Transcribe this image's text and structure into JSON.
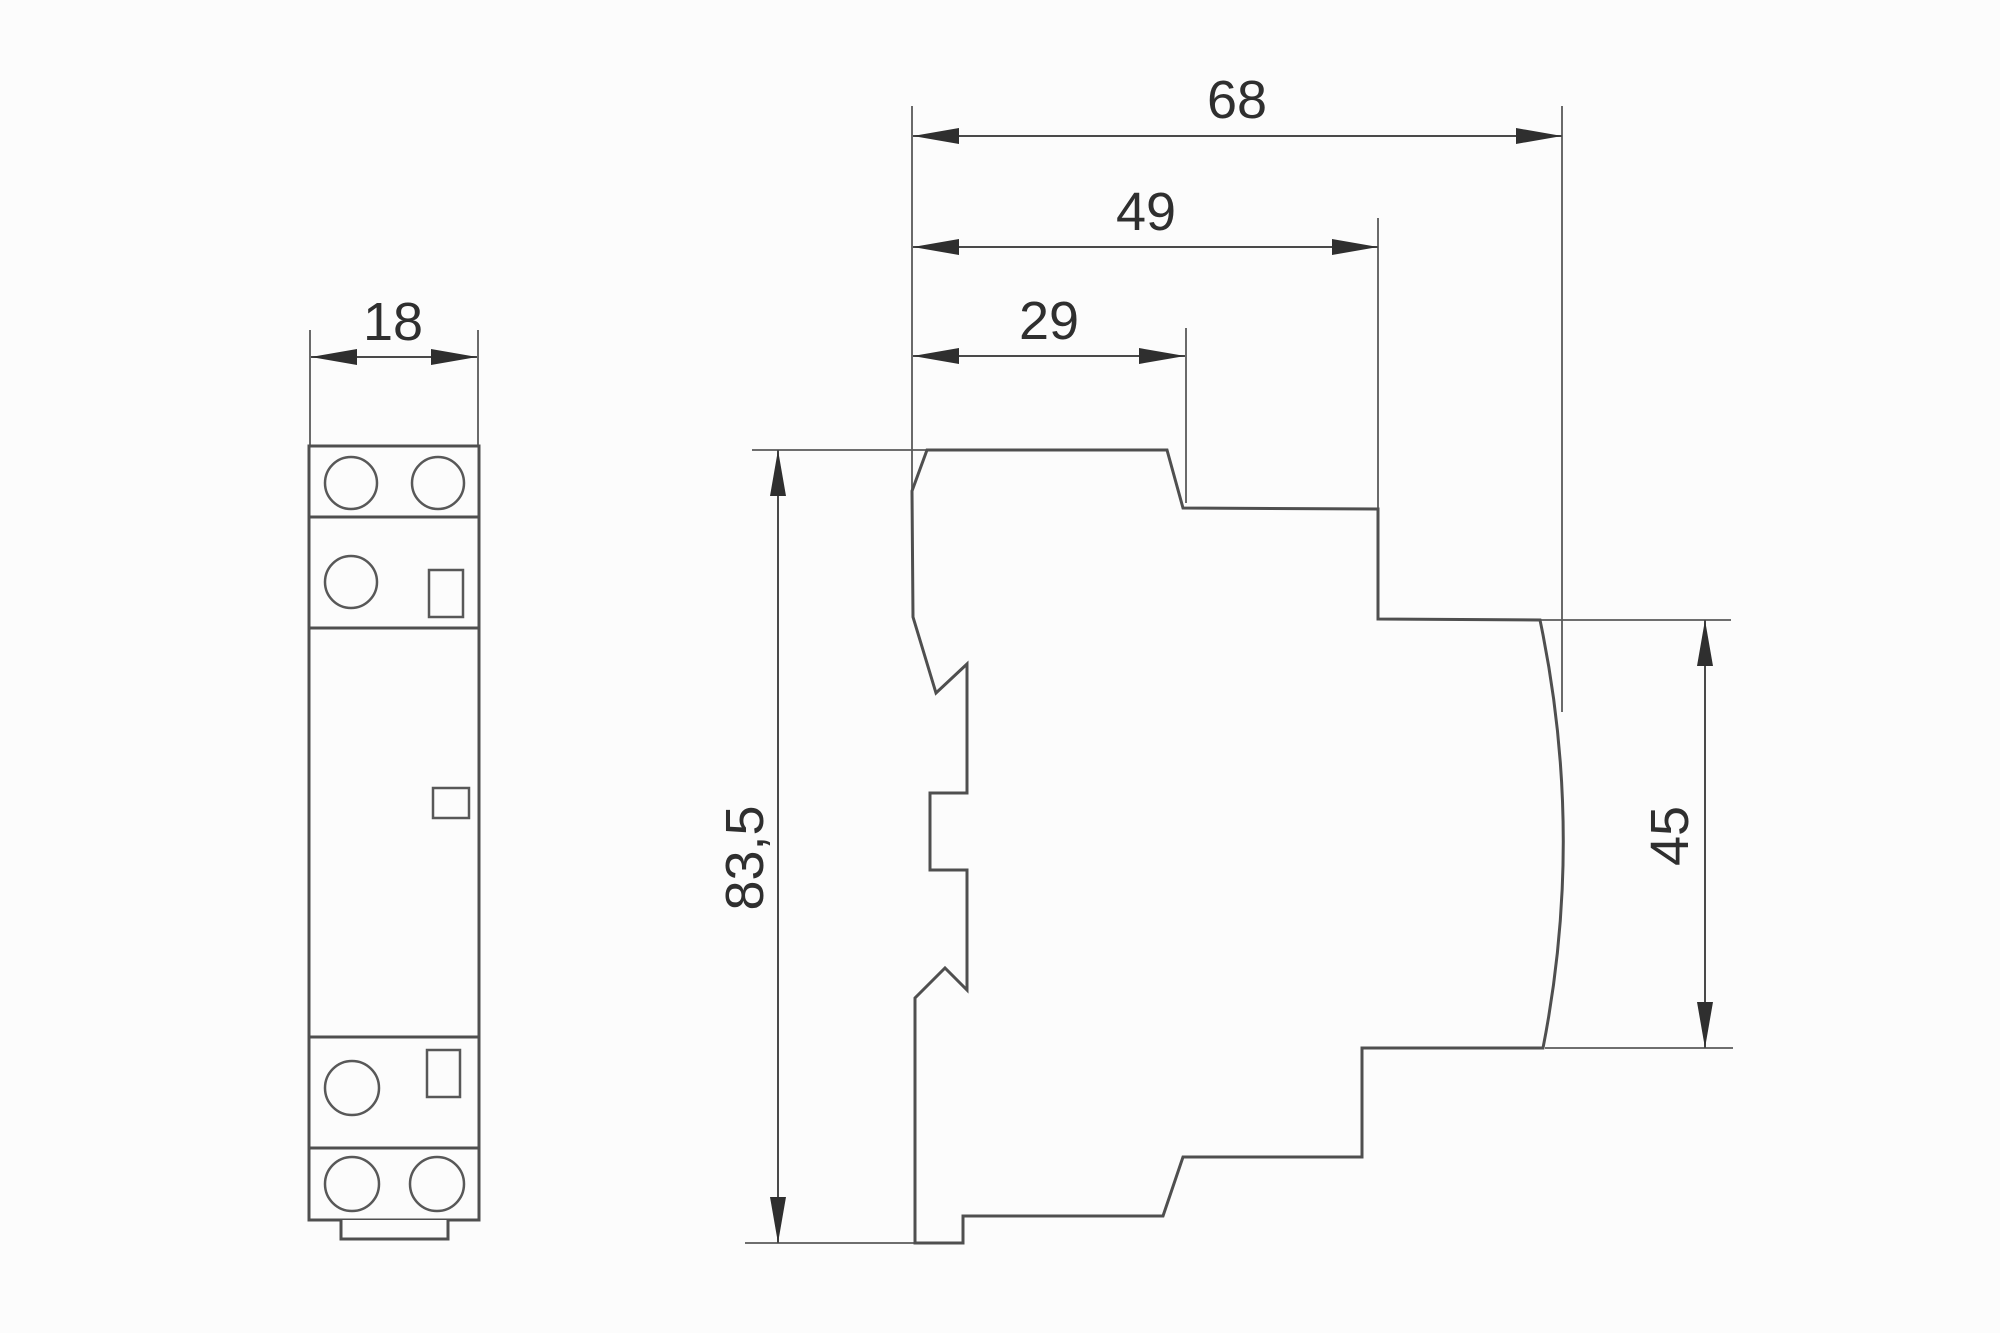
{
  "drawing": {
    "kind": "technical dimension drawing",
    "subject": "DIN-rail modular contactor, front and side views",
    "dimensions": {
      "front_width": "18",
      "side_overall_depth": "68",
      "side_upper_depth": "49",
      "side_top_depth": "29",
      "side_overall_height": "83,5",
      "side_right_height": "45"
    },
    "values_mm": {
      "front_width": 18,
      "side_overall_depth": 68,
      "side_upper_depth": 49,
      "side_top_depth": 29,
      "side_overall_height": 83.5,
      "side_right_height": 45
    }
  },
  "colors": {
    "background": "#fcfcfc",
    "line": "#4f4f4f",
    "text": "#2f2f2f"
  }
}
